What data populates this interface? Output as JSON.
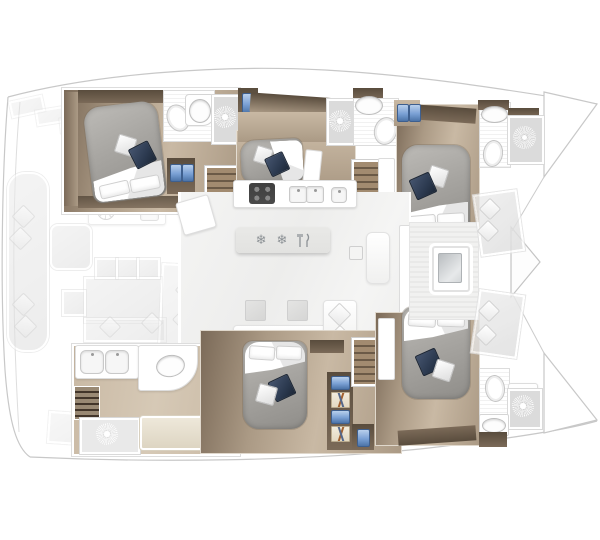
{
  "title": "Catamaran 6-cabin interior layout floor plan (top view, bow right)",
  "colors": {
    "wood": "#ab9a85",
    "woodLight": "#c9b9a4",
    "woodDark": "#7b6a58",
    "woodDeep": "#594c3d",
    "mattress": "#a7a5a1",
    "pillowNavy": "#2c3a50",
    "fixtureBlue": "#7aa0d4",
    "showerFloor": "#dbdbdb",
    "island": "#e2e2e0",
    "stoveDark": "#454545",
    "stairLight": "#a28b70",
    "stairDark": "#6b5a47",
    "outline": "#c8c8c8"
  },
  "salon": {
    "island_icons": {
      "freezer": "❄",
      "fridge": "❄",
      "cutlery": "fork-and-knife"
    },
    "features": [
      "galley counter with 4-burner stove",
      "double sink",
      "small appliance",
      "fridge-freezer island",
      "L-shaped sofa with two coffee tables",
      "forward-facing bench"
    ]
  },
  "port_hull": {
    "aft_cabin": [
      "island double bed",
      "navy throw pillow",
      "white throw pillow",
      "ensuite with toilet, washbasin, sunburst shower",
      "wardrobe with blue garment",
      "twin blue lockers",
      "companionway stairs"
    ],
    "mid_cabin": [
      "double bed with navy and white pillows",
      "white door panel",
      "ensuite with sunburst shower, washbasin, toilet"
    ],
    "fwd_cabin": [
      "double bed with duvet",
      "twin blue washbasins",
      "ensuite with washbasin, toilet, sunburst shower",
      "companionway stairs"
    ]
  },
  "starboard_hull": {
    "aft_area": [
      "twin-sink vanity",
      "oval washbasin",
      "dark steps",
      "sunburst shower room",
      "bench seat",
      "companionway stairs"
    ],
    "mid_cabin": [
      "double bed with head pillows and duvet",
      "navy and white throw pillows",
      "wardrobe column with blue towels and hangers"
    ],
    "fwd_cabin": [
      "double bed with duvet",
      "ensuite with toilet, sunburst shower, washbasin vanity",
      "companionway stairs"
    ]
  },
  "aft_cockpit": [
    "curved transom bench with four diamond cushions",
    "wet bar with round grill and sink",
    "cool box",
    "dining table",
    "three chairs",
    "side chair",
    "bench with two diamond cushions"
  ],
  "foredeck": [
    "forward cockpit deck",
    "deck hatch with glass",
    "two seat pads with diamond cushions",
    "forepeak anchor locker triangle",
    "port bow tip",
    "starboard bow tip"
  ],
  "shower_count": 5,
  "bed_count": 5
}
